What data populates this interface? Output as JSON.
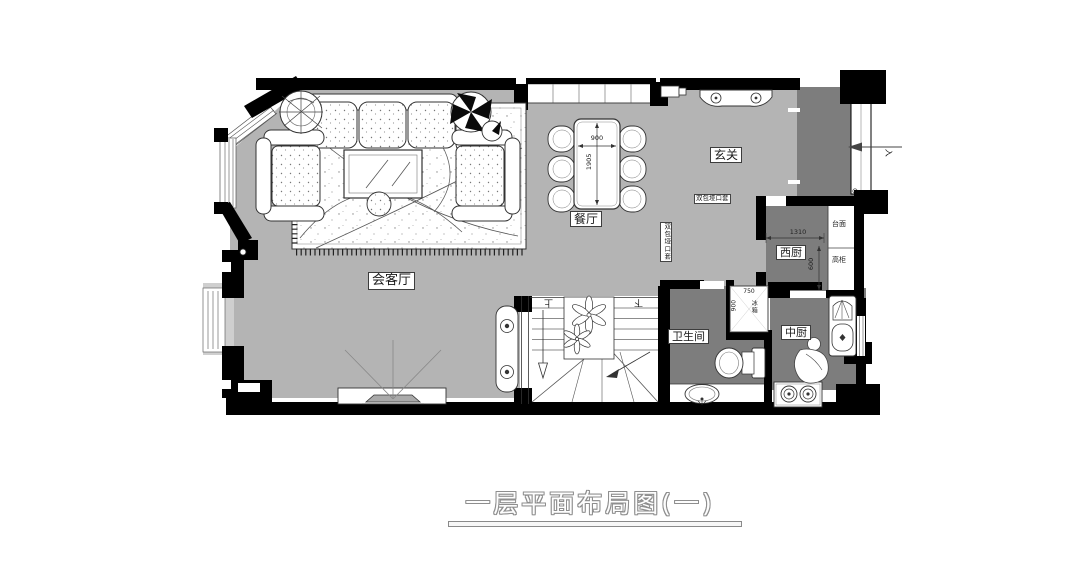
{
  "title": "一层平面布局图(一)",
  "rooms": {
    "living": "会客厅",
    "dining": "餐厅",
    "foyer": "玄关",
    "bathroom": "卫生间",
    "west_kitchen": "西厨",
    "chinese_kitchen": "中厨"
  },
  "stairs": {
    "up": "上",
    "down": "下"
  },
  "entry": {
    "direction_label": "入"
  },
  "annotations": {
    "door_casing_horizontal": "双包垭口套",
    "door_casing_vertical": "双包垭口套",
    "countertop": "台面",
    "tall_cabinet": "高柜",
    "fridge": "冰箱"
  },
  "dimensions": {
    "dining_table_width": "900",
    "dining_table_length": "1905",
    "west_kitchen_width": "1310",
    "west_kitchen_depth": "600",
    "fridge_width": "750",
    "fridge_depth": "900"
  },
  "colors": {
    "room_light": "#b4b4b4",
    "room_dark": "#7d7d7d",
    "wall": "#000000",
    "background": "#ffffff"
  }
}
